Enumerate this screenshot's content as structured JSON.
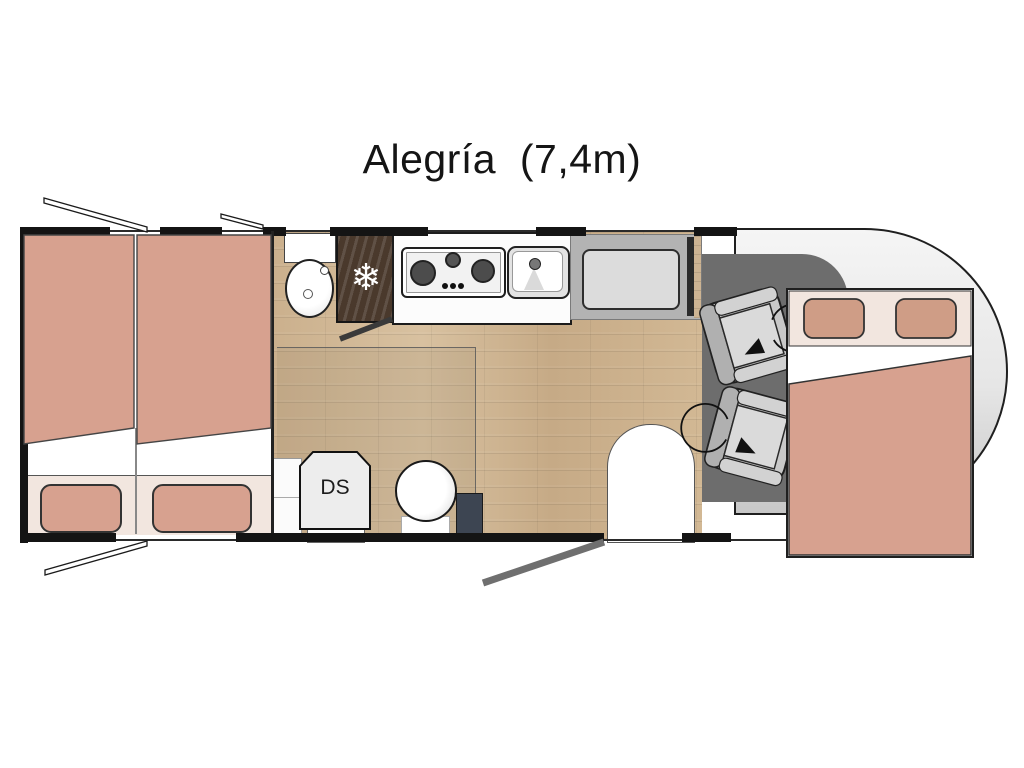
{
  "title": "Alegría  (7,4m)",
  "model": {
    "name": "Alegría",
    "length_label": "(7,4m)"
  },
  "labels": {
    "ds_cabinet": "DS"
  },
  "icons": {
    "fridge_snowflake": "❄",
    "seat_rotation": "curved-arrow"
  },
  "colors": {
    "wall": "#141414",
    "bed_salmon": "#d7a18f",
    "pillow_base": "#f2e6df",
    "floor_wood": "#cdb493",
    "cab_floor": "#6d6d6d",
    "fridge_wood": "#4a392c",
    "bench_gray": "#b3b3b3",
    "cushion_gray": "#dcdcdc",
    "nose_light": "#f5f5f5",
    "nose_dark": "#c7c7c7",
    "step_slate": "#3d4552",
    "door_swing_gray": "#6f6f6f"
  }
}
